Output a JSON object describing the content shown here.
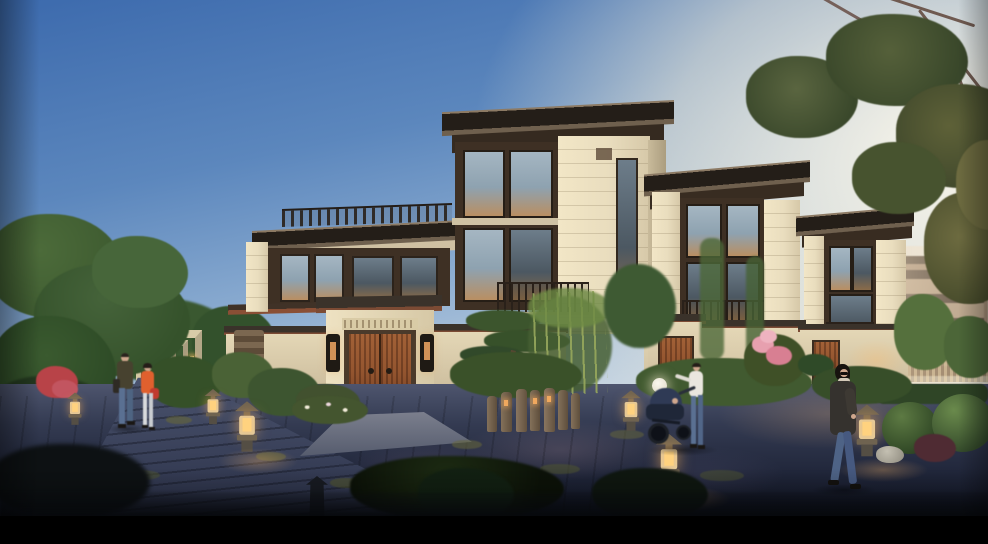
{
  "scene": {
    "type": "architectural-exterior-rendering",
    "description": "Dusk rendering of a modern Chinese-style villa community: cream stone townhouses with dark flat roofs and wood-trimmed windows, a carved entry gate with a red-brown wooden double door, stone garden lanterns glowing warm, landscaped pines and bamboo, a dark paved path with pedestrians, warm sunlight glow at right, black letterbox bar at bottom",
    "visible_text": "",
    "letterbox_bottom": true,
    "objects": [
      "sky",
      "sun-glow",
      "overhanging-branch",
      "left-tree",
      "distant-villa",
      "entry-pergola-corridor",
      "terrace-villa",
      "central-villa",
      "right-villa-1",
      "right-villa-2",
      "distant-buildings",
      "main-courtyard-gate",
      "wooden-double-door",
      "door-sconces",
      "drum-stones",
      "courtyard-walls",
      "stone-pillar",
      "garden-shrubs",
      "pine-tree",
      "bamboo-grove",
      "stone-bollard-lamps",
      "pagoda-lanterns",
      "sphere-lamp",
      "flowering-shrub",
      "stone-path",
      "paved-road",
      "walking-couple",
      "woman-in-orange",
      "mother-with-stroller",
      "baby-stroller",
      "woman-in-dark-coat",
      "topiary-bushes",
      "white-rock",
      "letterbox-bar"
    ]
  },
  "palette": {
    "sky-top": "#3c6aad",
    "sky-mid": "#8fafd2",
    "sky-low": "#e2e2d6",
    "sun-glow": "#fff6e2",
    "leaf-dark": "#3a4f2a",
    "leaf-olive": "#55603a",
    "tree-green": "#47683a",
    "tree-deep": "#2b4424",
    "wall-cream": "#e9ddbe",
    "wall-warm": "#f2e6c6",
    "wall-shade": "#c9bb9c",
    "wood-band": "#3e3024",
    "roof-dark": "#241e18",
    "glass-cool": "#a5b6c2",
    "glass-warm": "#b98f62",
    "door-wood": "#94552f",
    "door-wood-dark": "#6b3a22",
    "railing": "#2a211a",
    "ground-light": "#59617b",
    "ground-mid": "#39405a",
    "ground-dark": "#181c2c",
    "moss": "#67673a",
    "lantern-body": "#ddd0ab",
    "lantern-glow": "#ffd27f",
    "flower-pink": "#e7a0af",
    "flower-red": "#b84348",
    "orange-jacket": "#e0602e",
    "denim": "#5a7092",
    "skin": "#cfa78d",
    "coat-dark": "#35322e",
    "distant-warm": "#a18a72",
    "distant-dark": "#55463a",
    "bamboo": "#97a85c",
    "letterbox": "#000000"
  }
}
